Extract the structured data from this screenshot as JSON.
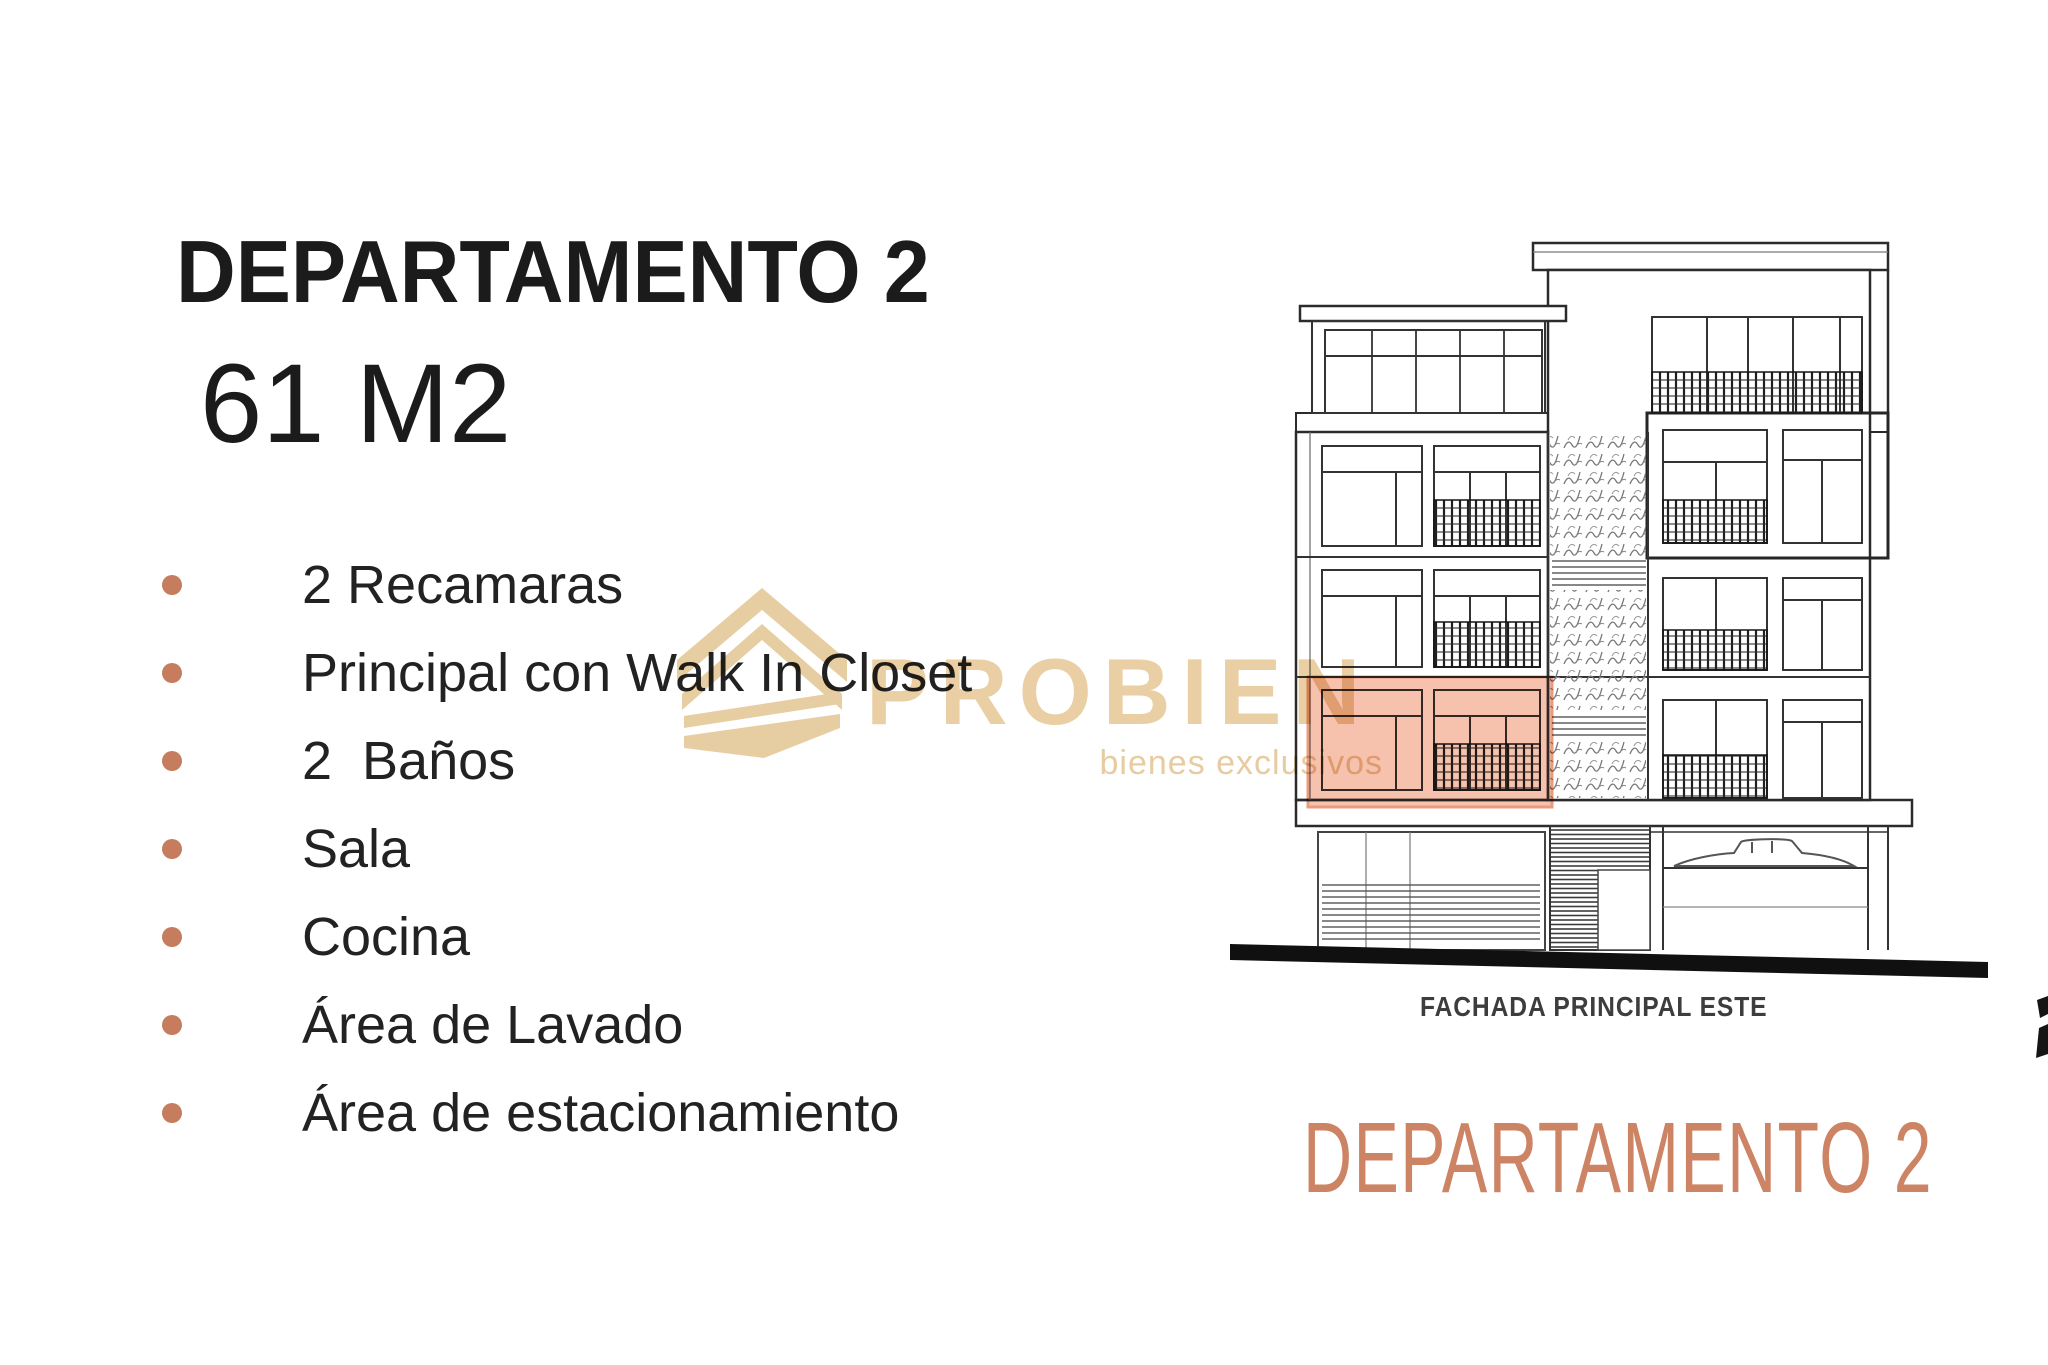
{
  "slide": {
    "title": "DEPARTAMENTO 2",
    "area": "61 M2",
    "features": [
      "2 Recamaras",
      "Principal con Walk In Closet",
      "2  Baños",
      "Sala",
      "Cocina",
      "Área de Lavado",
      "Área de estacionamiento"
    ],
    "elevation": {
      "caption": "FACHADA PRINCIPAL ESTE",
      "label": "DEPARTAMENTO 2",
      "highlight_color": "#f2ab8f",
      "highlight_border_color": "#eb9b7d"
    },
    "watermark": {
      "brand": "PROBIEN",
      "tagline": "bienes exclusivos",
      "icon": "stacked-chevrons-building-icon",
      "color": "#e9cfa3"
    },
    "colors": {
      "bullet": "#c67d5e",
      "accent_text": "#cd8464",
      "body_text": "#1c1c1c",
      "background": "#ffffff"
    }
  }
}
